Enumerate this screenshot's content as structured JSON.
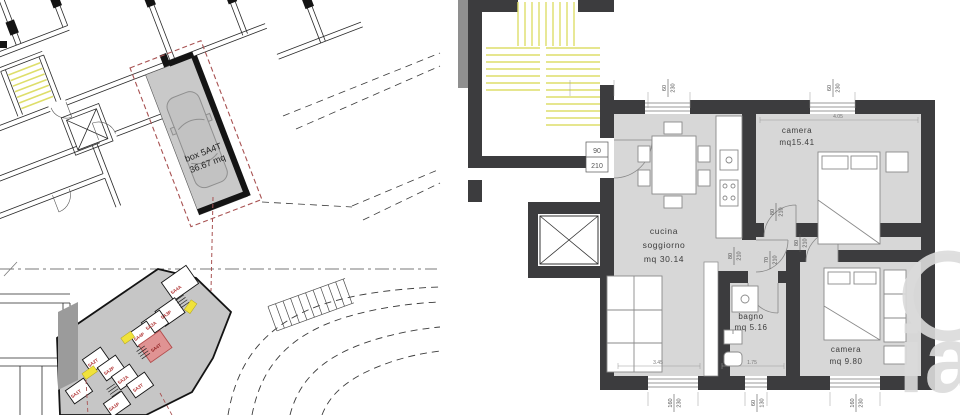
{
  "site_plan": {
    "garage": {
      "lines": [
        "box 5A4T",
        "36.67 mq"
      ]
    },
    "parking": [
      {
        "label": "5A4A"
      },
      {
        "label": "5A3P"
      },
      {
        "label": "5A3A"
      },
      {
        "label": "5A4P"
      },
      {
        "label": "5A4T"
      },
      {
        "label": "5A2T"
      },
      {
        "label": "5A2P"
      },
      {
        "label": "5A2A"
      },
      {
        "label": "5A3T"
      },
      {
        "label": "5A1T"
      },
      {
        "label": "5A1P"
      }
    ]
  },
  "floor_plan": {
    "rooms": [
      {
        "lines": [
          "camera",
          "mq15.41"
        ]
      },
      {
        "lines": [
          "cucina",
          "soggiorno",
          "mq 30.14"
        ]
      },
      {
        "lines": [
          "bagno",
          "mq 5.16"
        ]
      },
      {
        "lines": [
          "camera",
          "mq 9.80"
        ]
      }
    ],
    "openings": {
      "entry": {
        "w": "90",
        "h": "210"
      },
      "window_top_1": {
        "w": "60",
        "h": "230"
      },
      "window_top_2": {
        "w": "60",
        "h": "230"
      },
      "door_camera1": {
        "w": "80",
        "h": "210"
      },
      "door_hall": {
        "w": "80",
        "h": "210"
      },
      "door_camera2": {
        "w": "80",
        "h": "210"
      },
      "door_bagno": {
        "w": "70",
        "h": "210"
      },
      "window_bottom_living": {
        "w": "160",
        "h": "230"
      },
      "window_bottom_bagno": {
        "w": "60",
        "h": "130"
      },
      "window_bottom_camera": {
        "w": "160",
        "h": "230"
      }
    },
    "dims": {
      "camera1_width": "4.05",
      "living_width": "3.45",
      "bagno_width": "1.75"
    }
  },
  "watermark": {
    "text": "ia"
  },
  "colors": {
    "wall_dark": "#3c3c3e",
    "room_gray": "#d7d7d7",
    "stair_yellow": "#dede6a",
    "highlight_yellow": "#f0e23a",
    "selected_red": "#e09393",
    "dash_red": "#a85252",
    "watermark_gray": "#dbdbdb"
  }
}
